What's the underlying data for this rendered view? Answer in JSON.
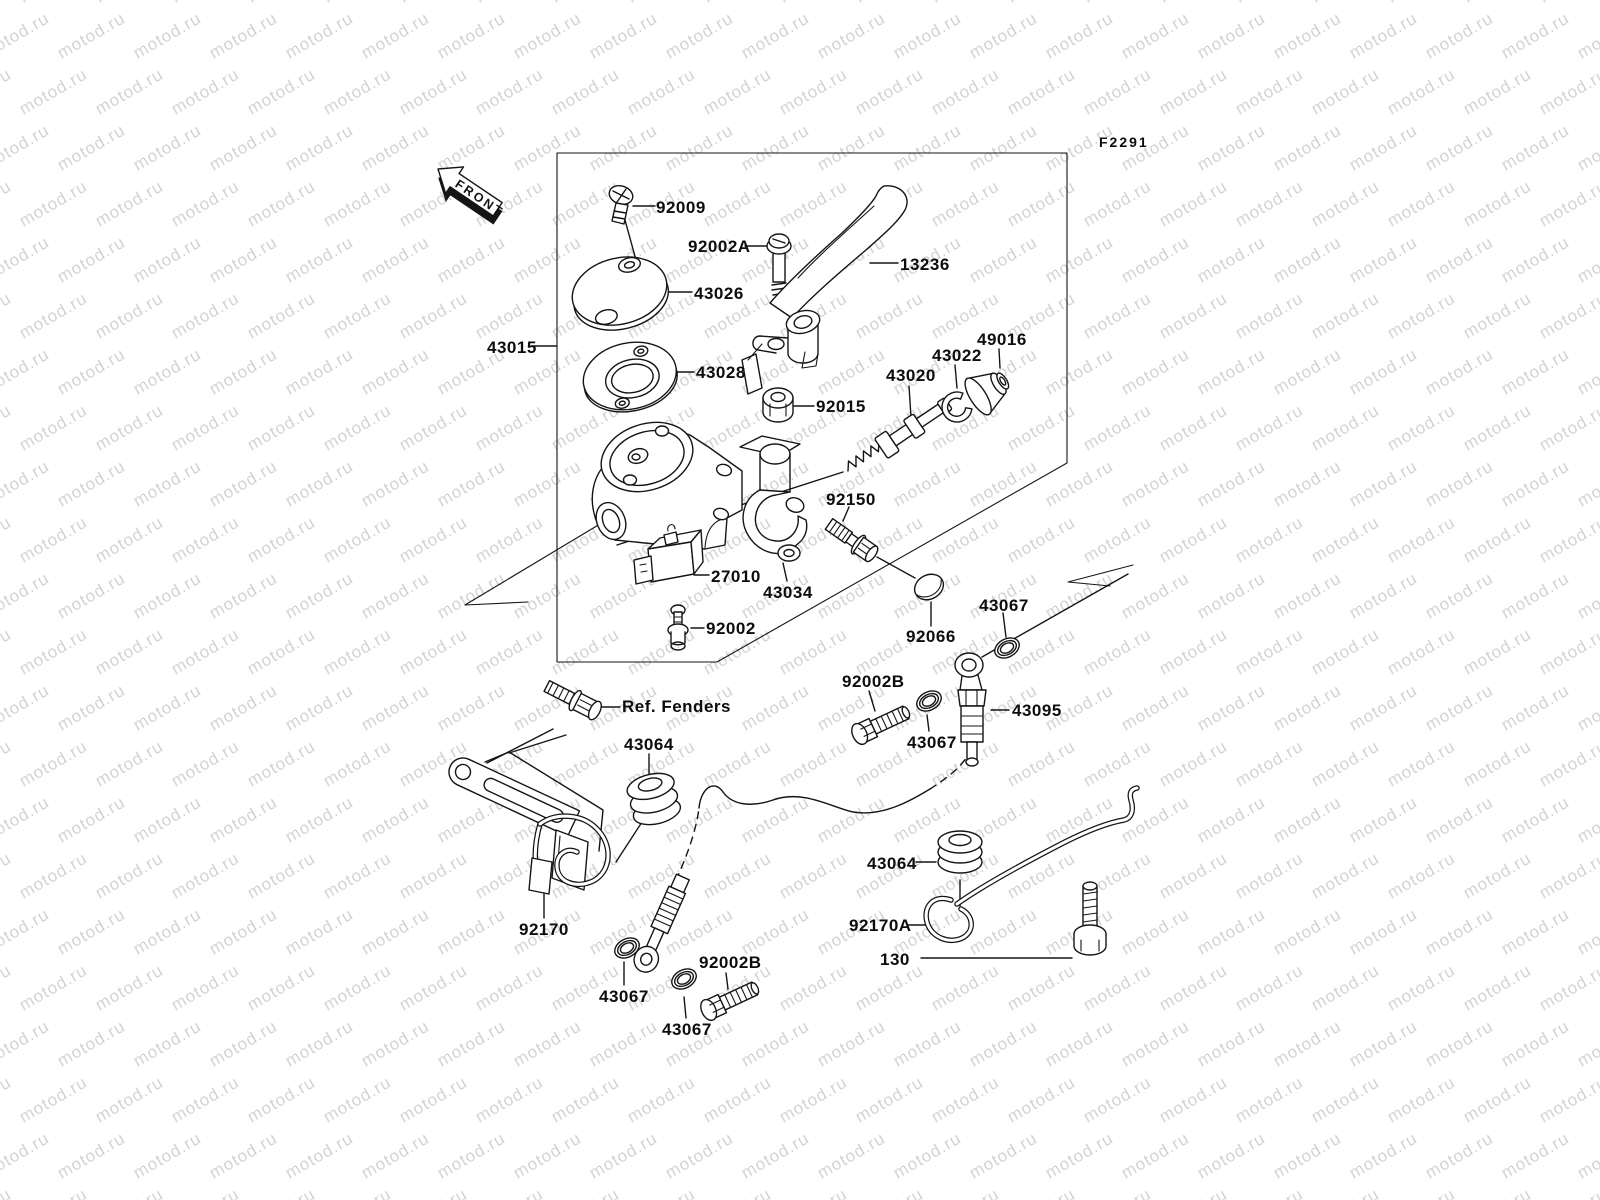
{
  "page": {
    "width": 1600,
    "height": 1200,
    "background": "#ffffff",
    "ink": "#151515"
  },
  "watermark": {
    "text": "motod.ru",
    "color": "#d3d3d3",
    "font_size_px": 17,
    "rotation_deg": -30,
    "tile_x": 76,
    "tile_y": 56,
    "row_stagger": 38
  },
  "figure": {
    "code": "F2291"
  },
  "front_arrow": {
    "label": "FRONT"
  },
  "parts": {
    "labels": [
      {
        "text": "92009"
      },
      {
        "text": "92002A"
      },
      {
        "text": "13236"
      },
      {
        "text": "43026"
      },
      {
        "text": "43015"
      },
      {
        "text": "43028"
      },
      {
        "text": "92015"
      },
      {
        "text": "43020"
      },
      {
        "text": "43022"
      },
      {
        "text": "49016"
      },
      {
        "text": "92150"
      },
      {
        "text": "27010"
      },
      {
        "text": "43034"
      },
      {
        "text": "92002"
      },
      {
        "text": "43067"
      },
      {
        "text": "92066"
      },
      {
        "text": "92002B"
      },
      {
        "text": "43067"
      },
      {
        "text": "43095"
      },
      {
        "text": "Ref. Fenders"
      },
      {
        "text": "43064"
      },
      {
        "text": "92170"
      },
      {
        "text": "43067"
      },
      {
        "text": "43067"
      },
      {
        "text": "92002B"
      },
      {
        "text": "43064"
      },
      {
        "text": "92170A"
      },
      {
        "text": "130"
      }
    ]
  }
}
